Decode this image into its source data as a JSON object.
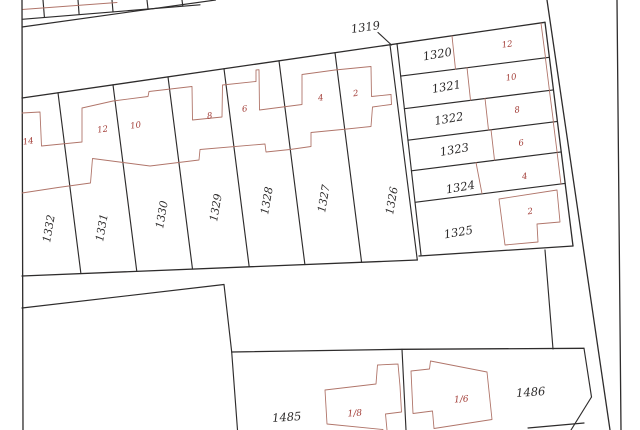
{
  "map_type": "cadastral-parcel-map",
  "colors": {
    "background": "#ffffff",
    "boundary_line": "#2e2c2c",
    "building_outline": "#b0756a",
    "house_number_text": "#a23c36",
    "parcel_number_text": "#2e2c2c"
  },
  "pointer": {
    "label": "1319"
  },
  "parcels": {
    "row": [
      {
        "number": "1332",
        "house": "14"
      },
      {
        "number": "1331",
        "house": "12"
      },
      {
        "number": "1330",
        "house": "10"
      },
      {
        "number": "1329",
        "house": "8"
      },
      {
        "number": "1328",
        "house": "6"
      },
      {
        "number": "1327",
        "house": "4"
      },
      {
        "number": "1326",
        "house": "2"
      }
    ],
    "block": [
      {
        "number": "1320",
        "house": "12"
      },
      {
        "number": "1321",
        "house": "10"
      },
      {
        "number": "1322",
        "house": "8"
      },
      {
        "number": "1323",
        "house": "6"
      },
      {
        "number": "1324",
        "house": "4"
      },
      {
        "number": "1325",
        "house": "2"
      }
    ],
    "south": [
      {
        "number": "1485",
        "house": "1/8"
      },
      {
        "number": "1486",
        "house": "1/6"
      }
    ]
  }
}
